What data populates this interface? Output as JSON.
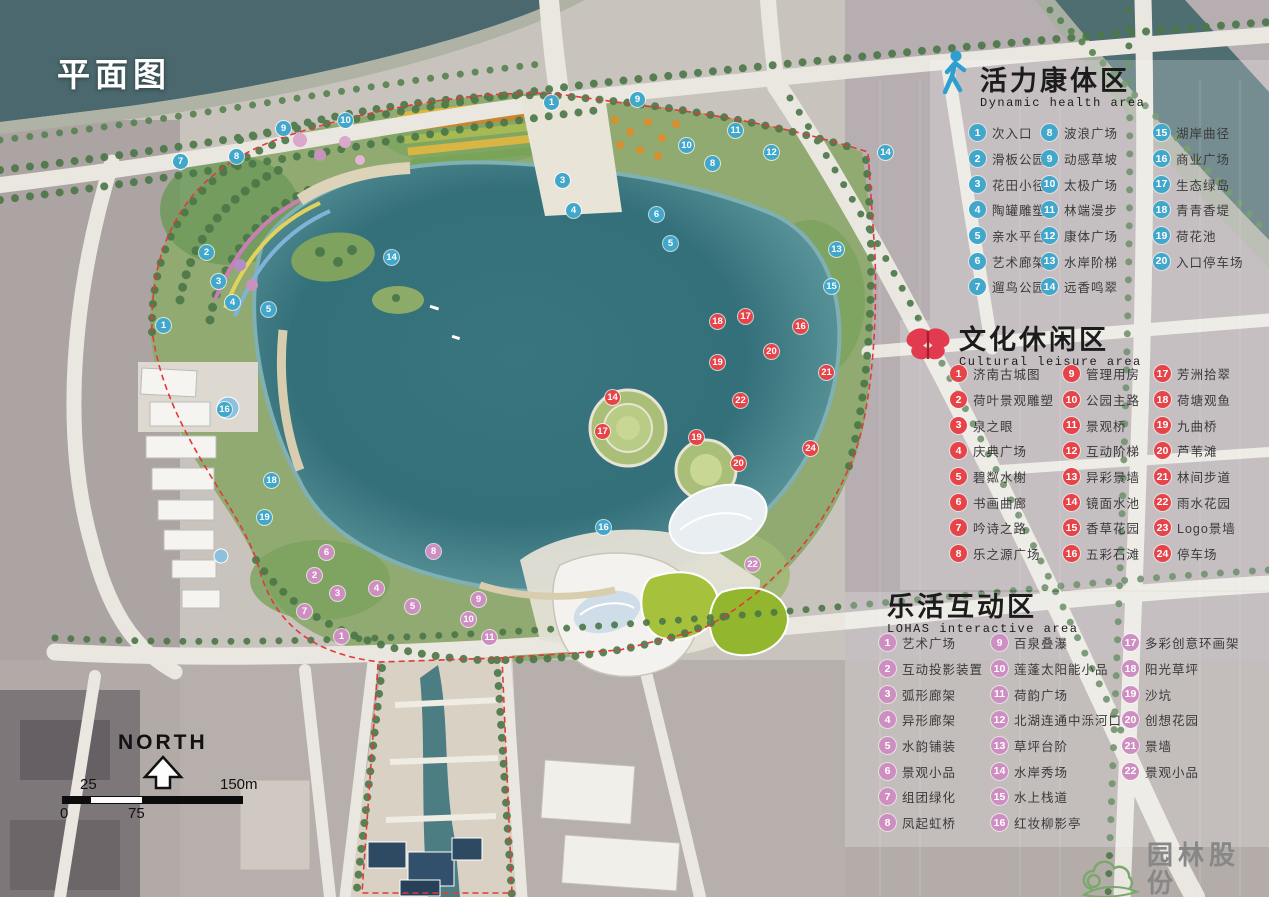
{
  "title": "平面图",
  "marker_colors": {
    "health": "#41a7cb",
    "cultural": "#e64449",
    "lohas": "#cf8ec2"
  },
  "legends": [
    {
      "id": "health",
      "icon": "walking-person-icon",
      "title_zh": "活力康体区",
      "title_en": "Dynamic health area",
      "color": "#41a7cb",
      "items": [
        {
          "num": "1",
          "label": "次入口"
        },
        {
          "num": "2",
          "label": "滑板公园"
        },
        {
          "num": "3",
          "label": "花田小径"
        },
        {
          "num": "4",
          "label": "陶罐雕塑"
        },
        {
          "num": "5",
          "label": "亲水平台"
        },
        {
          "num": "6",
          "label": "艺术廊架"
        },
        {
          "num": "7",
          "label": "遛鸟公园"
        },
        {
          "num": "8",
          "label": "波浪广场"
        },
        {
          "num": "9",
          "label": "动感草坡"
        },
        {
          "num": "10",
          "label": "太极广场"
        },
        {
          "num": "11",
          "label": "林端漫步"
        },
        {
          "num": "12",
          "label": "康体广场"
        },
        {
          "num": "13",
          "label": "水岸阶梯"
        },
        {
          "num": "14",
          "label": "远香鸣翠"
        },
        {
          "num": "15",
          "label": "湖岸曲径"
        },
        {
          "num": "16",
          "label": "商业广场"
        },
        {
          "num": "17",
          "label": "生态绿岛"
        },
        {
          "num": "18",
          "label": "青青香堤"
        },
        {
          "num": "19",
          "label": "荷花池"
        },
        {
          "num": "20",
          "label": "入口停车场"
        }
      ]
    },
    {
      "id": "cultural",
      "icon": "butterfly-icon",
      "title_zh": "文化休闲区",
      "title_en": "Cultural leisure area",
      "color": "#e64449",
      "items": [
        {
          "num": "1",
          "label": "济南古城图"
        },
        {
          "num": "2",
          "label": "荷叶景观雕塑"
        },
        {
          "num": "3",
          "label": "泉之眼"
        },
        {
          "num": "4",
          "label": "庆典广场"
        },
        {
          "num": "5",
          "label": "碧粼水榭"
        },
        {
          "num": "6",
          "label": "书画曲廊"
        },
        {
          "num": "7",
          "label": "吟诗之路"
        },
        {
          "num": "8",
          "label": "乐之源广场"
        },
        {
          "num": "9",
          "label": "管理用房"
        },
        {
          "num": "10",
          "label": "公园主路"
        },
        {
          "num": "11",
          "label": "景观桥"
        },
        {
          "num": "12",
          "label": "互动阶梯"
        },
        {
          "num": "13",
          "label": "异彩景墙"
        },
        {
          "num": "14",
          "label": "镜面水池"
        },
        {
          "num": "15",
          "label": "香草花园"
        },
        {
          "num": "16",
          "label": "五彩石滩"
        },
        {
          "num": "17",
          "label": "芳洲拾翠"
        },
        {
          "num": "18",
          "label": "荷塘观鱼"
        },
        {
          "num": "19",
          "label": "九曲桥"
        },
        {
          "num": "20",
          "label": "芦苇滩"
        },
        {
          "num": "21",
          "label": "林间步道"
        },
        {
          "num": "22",
          "label": "雨水花园"
        },
        {
          "num": "23",
          "label": "Logo景墙"
        },
        {
          "num": "24",
          "label": "停车场"
        }
      ]
    },
    {
      "id": "lohas",
      "icon": "crescent-moon-icon",
      "title_zh": "乐活互动区",
      "title_en": "LOHAS interactive area",
      "color": "#cf8ec2",
      "items": [
        {
          "num": "1",
          "label": "艺术广场"
        },
        {
          "num": "2",
          "label": "互动投影装置"
        },
        {
          "num": "3",
          "label": "弧形廊架"
        },
        {
          "num": "4",
          "label": "异形廊架"
        },
        {
          "num": "5",
          "label": "水韵铺装"
        },
        {
          "num": "6",
          "label": "景观小品"
        },
        {
          "num": "7",
          "label": "组团绿化"
        },
        {
          "num": "8",
          "label": "凤起虹桥"
        },
        {
          "num": "9",
          "label": "百泉叠瀑"
        },
        {
          "num": "10",
          "label": "莲蓬太阳能小品"
        },
        {
          "num": "11",
          "label": "荷韵广场"
        },
        {
          "num": "12",
          "label": "北湖连通中泺河口"
        },
        {
          "num": "13",
          "label": "草坪台阶"
        },
        {
          "num": "14",
          "label": "水岸秀场"
        },
        {
          "num": "15",
          "label": "水上栈道"
        },
        {
          "num": "16",
          "label": "红妆柳影亭"
        },
        {
          "num": "17",
          "label": "多彩创意环画架"
        },
        {
          "num": "18",
          "label": "阳光草坪"
        },
        {
          "num": "19",
          "label": "沙坑"
        },
        {
          "num": "20",
          "label": "创想花园"
        },
        {
          "num": "21",
          "label": "景墙"
        },
        {
          "num": "22",
          "label": "景观小品"
        }
      ]
    }
  ],
  "map_markers": [
    {
      "area": "health",
      "num": "9",
      "x": 283,
      "y": 128
    },
    {
      "area": "health",
      "num": "10",
      "x": 345,
      "y": 120
    },
    {
      "area": "health",
      "num": "8",
      "x": 236,
      "y": 156
    },
    {
      "area": "health",
      "num": "7",
      "x": 180,
      "y": 161
    },
    {
      "area": "health",
      "num": "2",
      "x": 206,
      "y": 252
    },
    {
      "area": "health",
      "num": "3",
      "x": 218,
      "y": 281
    },
    {
      "area": "health",
      "num": "4",
      "x": 232,
      "y": 302
    },
    {
      "area": "health",
      "num": "5",
      "x": 268,
      "y": 309
    },
    {
      "area": "health",
      "num": "1",
      "x": 163,
      "y": 325
    },
    {
      "area": "health",
      "num": "14",
      "x": 391,
      "y": 257
    },
    {
      "area": "health",
      "num": "1",
      "x": 551,
      "y": 102
    },
    {
      "area": "health",
      "num": "3",
      "x": 562,
      "y": 180
    },
    {
      "area": "health",
      "num": "4",
      "x": 573,
      "y": 210
    },
    {
      "area": "health",
      "num": "9",
      "x": 637,
      "y": 99
    },
    {
      "area": "health",
      "num": "10",
      "x": 686,
      "y": 145
    },
    {
      "area": "health",
      "num": "11",
      "x": 735,
      "y": 130
    },
    {
      "area": "health",
      "num": "12",
      "x": 771,
      "y": 152
    },
    {
      "area": "health",
      "num": "8",
      "x": 712,
      "y": 163
    },
    {
      "area": "health",
      "num": "14",
      "x": 885,
      "y": 152
    },
    {
      "area": "health",
      "num": "6",
      "x": 656,
      "y": 214
    },
    {
      "area": "health",
      "num": "5",
      "x": 670,
      "y": 243
    },
    {
      "area": "health",
      "num": "13",
      "x": 836,
      "y": 249
    },
    {
      "area": "health",
      "num": "15",
      "x": 831,
      "y": 286
    },
    {
      "area": "health",
      "num": "16",
      "x": 224,
      "y": 409
    },
    {
      "area": "health",
      "num": "18",
      "x": 271,
      "y": 480
    },
    {
      "area": "health",
      "num": "19",
      "x": 264,
      "y": 517
    },
    {
      "area": "health",
      "num": "16",
      "x": 603,
      "y": 527
    },
    {
      "area": "cultural",
      "num": "18",
      "x": 717,
      "y": 321
    },
    {
      "area": "cultural",
      "num": "17",
      "x": 745,
      "y": 316
    },
    {
      "area": "cultural",
      "num": "19",
      "x": 717,
      "y": 362
    },
    {
      "area": "cultural",
      "num": "20",
      "x": 771,
      "y": 351
    },
    {
      "area": "cultural",
      "num": "16",
      "x": 800,
      "y": 326
    },
    {
      "area": "cultural",
      "num": "21",
      "x": 826,
      "y": 372
    },
    {
      "area": "cultural",
      "num": "22",
      "x": 740,
      "y": 400
    },
    {
      "area": "cultural",
      "num": "14",
      "x": 612,
      "y": 397
    },
    {
      "area": "cultural",
      "num": "17",
      "x": 602,
      "y": 431
    },
    {
      "area": "cultural",
      "num": "19",
      "x": 696,
      "y": 437
    },
    {
      "area": "cultural",
      "num": "20",
      "x": 738,
      "y": 463
    },
    {
      "area": "cultural",
      "num": "24",
      "x": 810,
      "y": 448
    },
    {
      "area": "lohas",
      "num": "22",
      "x": 752,
      "y": 564
    },
    {
      "area": "lohas",
      "num": "8",
      "x": 433,
      "y": 551
    },
    {
      "area": "lohas",
      "num": "6",
      "x": 326,
      "y": 552
    },
    {
      "area": "lohas",
      "num": "2",
      "x": 314,
      "y": 575
    },
    {
      "area": "lohas",
      "num": "3",
      "x": 337,
      "y": 593
    },
    {
      "area": "lohas",
      "num": "4",
      "x": 376,
      "y": 588
    },
    {
      "area": "lohas",
      "num": "5",
      "x": 412,
      "y": 606
    },
    {
      "area": "lohas",
      "num": "7",
      "x": 304,
      "y": 611
    },
    {
      "area": "lohas",
      "num": "1",
      "x": 341,
      "y": 636
    },
    {
      "area": "lohas",
      "num": "11",
      "x": 489,
      "y": 637
    },
    {
      "area": "lohas",
      "num": "10",
      "x": 468,
      "y": 619
    },
    {
      "area": "lohas",
      "num": "9",
      "x": 478,
      "y": 599
    }
  ],
  "compass": {
    "label": "NORTH"
  },
  "scalebar": {
    "top_left": "25",
    "top_right": "150m",
    "bottom_left": "0",
    "bottom_mid": "75"
  },
  "logo": {
    "name": "园林股份",
    "stock_code": "股票代码:605303"
  }
}
